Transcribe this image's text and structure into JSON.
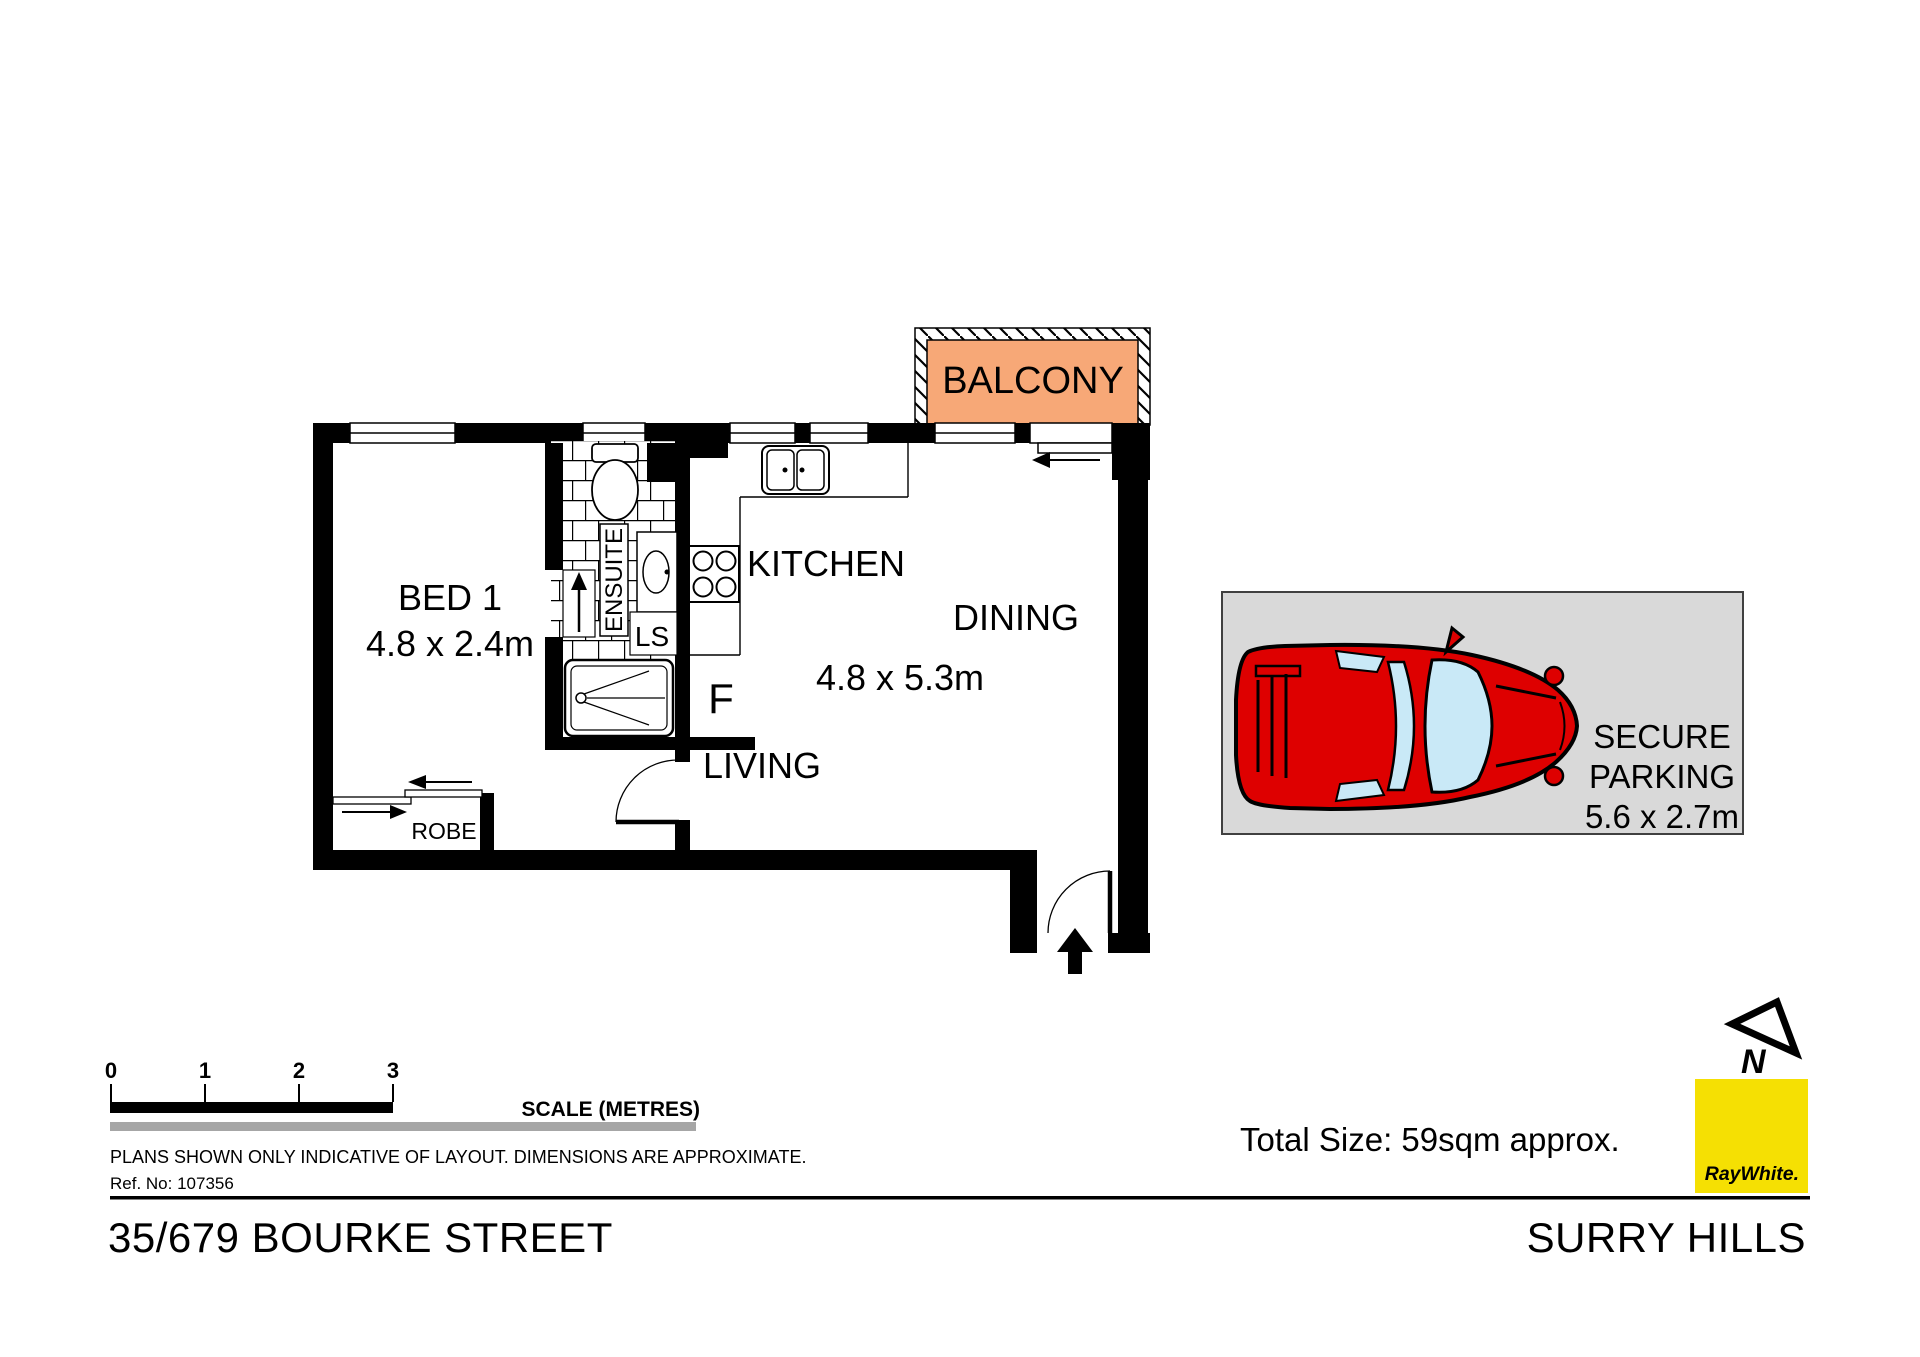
{
  "plan": {
    "balcony": "BALCONY",
    "bed1": "BED 1",
    "bed1_dims": "4.8 x 2.4m",
    "ensuite": "ENSUITE",
    "ls": "LS",
    "fridge": "F",
    "kitchen": "KITCHEN",
    "dining": "DINING",
    "living_dims": "4.8 x 5.3m",
    "living": "LIVING",
    "robe": "ROBE"
  },
  "parking": {
    "line1": "SECURE",
    "line2": "PARKING",
    "dims": "5.6 x 2.7m"
  },
  "scale_bar": {
    "ticks": [
      "0",
      "1",
      "2",
      "3"
    ],
    "label": "SCALE (METRES)"
  },
  "notes": {
    "disclaimer": "PLANS SHOWN ONLY INDICATIVE OF LAYOUT.  DIMENSIONS ARE APPROXIMATE.",
    "ref": "Ref. No: 107356"
  },
  "footer": {
    "address": "35/679 BOURKE STREET",
    "suburb": "SURRY HILLS",
    "total_size": "Total Size: 59sqm approx."
  },
  "branding": {
    "logo": "RayWhite.",
    "north": "N"
  },
  "colors": {
    "balcony": "#F7A877",
    "parking_bg": "#D9D9D9",
    "car": "#DE0000",
    "glass": "#C9E9F7",
    "brand_yellow": "#F5E003",
    "brand_text": "#54565B",
    "scale_gray": "#A6A6A6"
  }
}
